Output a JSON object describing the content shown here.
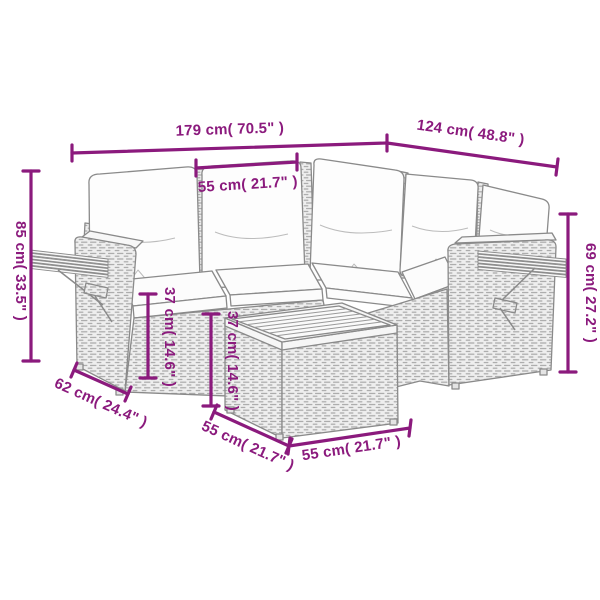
{
  "page": {
    "background": "#ffffff",
    "content_type": "product dimension diagram",
    "product": "rattan corner sofa set with back cushions, seat cushions, fold-out side trays and coffee table"
  },
  "colors": {
    "dimension": "#8B1A7D",
    "outline": "#8a8a8a",
    "wicker_fill": "#efefef",
    "wood_fill": "#f6f6f6",
    "cushion_fill": "#fdfdfd"
  },
  "dimensions": {
    "total_width": {
      "label": "179 cm( 70.5\" )",
      "placement": "top horizontal"
    },
    "right_depth": {
      "label": "124 cm( 48.8\" )",
      "placement": "top right diagonal"
    },
    "seat_width": {
      "label": "55 cm( 21.7\" )",
      "placement": "between back posts"
    },
    "total_height": {
      "label": "85 cm( 33.5\" )",
      "placement": "left vertical"
    },
    "right_height": {
      "label": "69 cm( 27.2\" )",
      "placement": "right vertical"
    },
    "seat_height": {
      "label": "37 cm( 14.6\" )",
      "placement": "sofa base vertical"
    },
    "table_height": {
      "label": "37 cm( 14.6\" )",
      "placement": "table side vertical"
    },
    "side_depth": {
      "label": "62 cm( 24.4\" )",
      "placement": "bottom left diagonal"
    },
    "table_depth": {
      "label": "55 cm( 21.7\" )",
      "placement": "table bottom left diagonal"
    },
    "table_width": {
      "label": "55 cm( 21.7\" )",
      "placement": "table bottom front"
    }
  }
}
